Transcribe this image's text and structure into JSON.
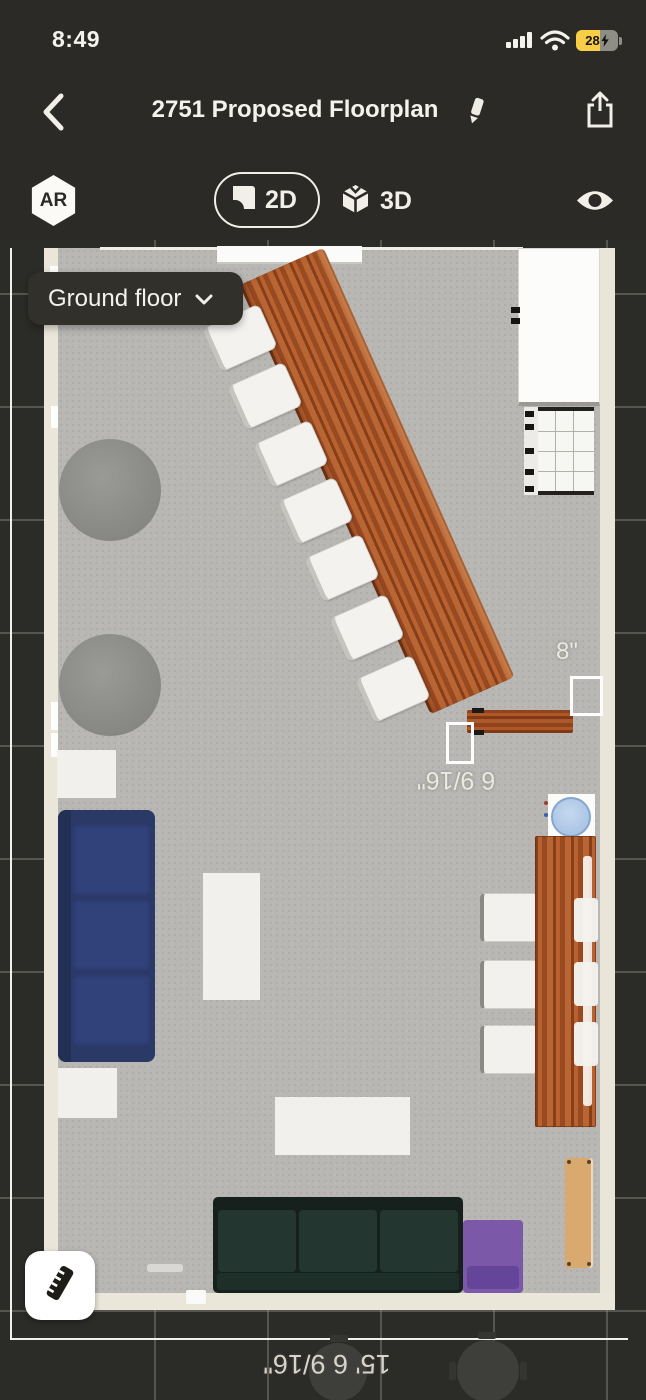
{
  "status_bar": {
    "time": "8:49",
    "battery_level": "28"
  },
  "nav_bar": {
    "title": "2751 Proposed Floorplan"
  },
  "view_toolbar": {
    "ar_badge": "AR",
    "mode_2d": "2D",
    "mode_3d": "3D"
  },
  "floor_selector": {
    "selected_floor": "Ground floor"
  },
  "measurements": {
    "opening_width_top": "8\"",
    "opening_width_side": "6 9/16\"",
    "bottom_wall_length": "15' 6 9/16\""
  },
  "furniture_inventory": [
    "diagonal wood bar counter",
    "7 bar stools",
    "wall shelf",
    "refrigerator",
    "storage rack",
    "2 round tables",
    "navy 3-seat sofa",
    "2 side tables",
    "coffee table",
    "rectangular table",
    "round blue sink",
    "wood dining table",
    "3 dining chairs",
    "3 tucked chairs",
    "dark green 3-seat sofa",
    "purple armchair",
    "wooden bench",
    "2 dimmed round tables outside plan"
  ],
  "icons": {
    "back": "chevron-left-icon",
    "edit": "pencil-icon",
    "share": "share-icon",
    "ar": "ar-hexagon-badge",
    "plan2d": "floorplan-2d-icon",
    "cube3d": "cube-3d-icon",
    "visibility": "eye-icon",
    "floor_chevron": "chevron-down-icon",
    "measure": "ruler-icon",
    "signal": "cellular-signal-icon",
    "wifi": "wifi-icon",
    "battery": "battery-charging-icon"
  },
  "colors": {
    "chrome_bg": "#2b2a26",
    "canvas_bg": "#2b2b27",
    "floor": "#b8b7b4",
    "wall": "#eae6da",
    "wood": "#a5552a",
    "navy_sofa": "#2a3966",
    "green_sofa": "#1c2b25",
    "purple_chair": "#7b58a8",
    "bench": "#d9a96f",
    "battery_yellow": "#f7ce45",
    "dim_text": "#ece9df"
  }
}
